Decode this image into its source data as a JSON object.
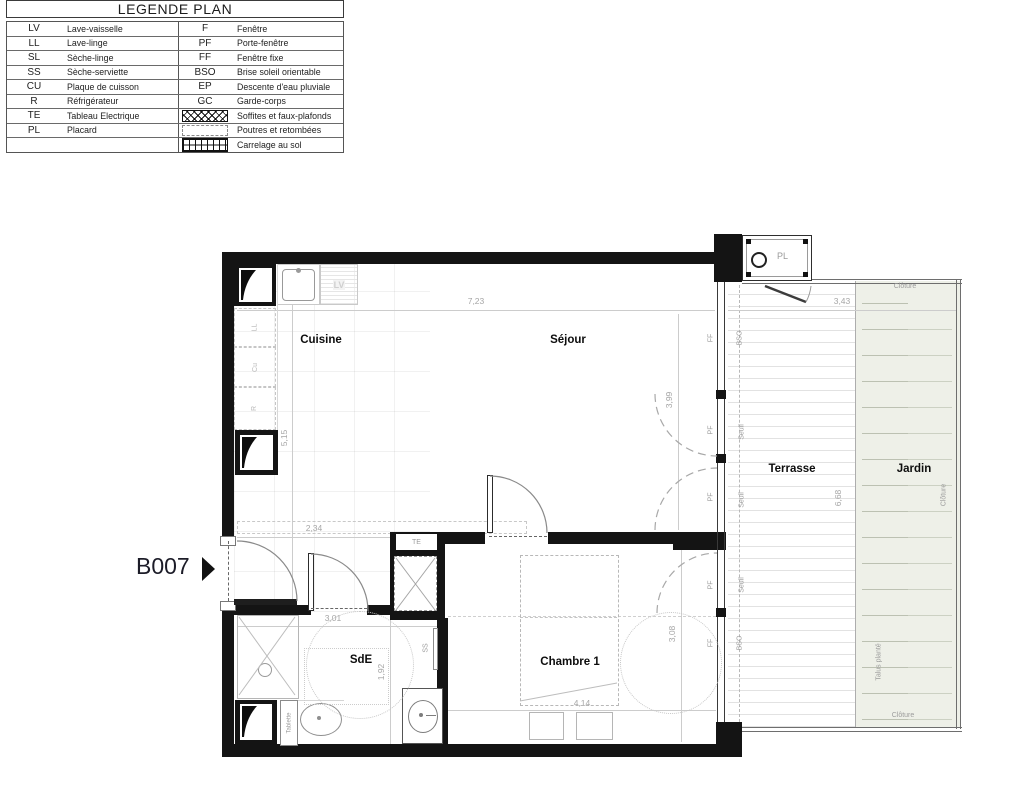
{
  "legend": {
    "title": "LEGENDE PLAN",
    "left": [
      {
        "abbr": "LV",
        "label": "Lave-vaisselle"
      },
      {
        "abbr": "LL",
        "label": "Lave-linge"
      },
      {
        "abbr": "SL",
        "label": "Sèche-linge"
      },
      {
        "abbr": "SS",
        "label": "Sèche-serviette"
      },
      {
        "abbr": "CU",
        "label": "Plaque de cuisson"
      },
      {
        "abbr": "R",
        "label": "Réfrigérateur"
      },
      {
        "abbr": "TE",
        "label": "Tableau Electrique"
      },
      {
        "abbr": "PL",
        "label": "Placard"
      },
      {
        "abbr": "",
        "label": ""
      }
    ],
    "right": [
      {
        "abbr": "F",
        "label": "Fenêtre"
      },
      {
        "abbr": "PF",
        "label": "Porte-fenêtre"
      },
      {
        "abbr": "FF",
        "label": "Fenêtre fixe"
      },
      {
        "abbr": "BSO",
        "label": "Brise soleil orientable"
      },
      {
        "abbr": "EP",
        "label": "Descente d'eau pluviale"
      },
      {
        "abbr": "GC",
        "label": "Garde-corps"
      },
      {
        "abbr": "",
        "label": "Soffites et faux-plafonds",
        "symbol": "x-hatch"
      },
      {
        "abbr": "",
        "label": "Poutres et retombées",
        "symbol": "dashed-rect"
      },
      {
        "abbr": "",
        "label": "Carrelage au sol",
        "symbol": "tile-grid"
      }
    ]
  },
  "plan": {
    "unit": "B007",
    "rooms": {
      "cuisine": "Cuisine",
      "sejour": "Séjour",
      "sde": "SdE",
      "chambre": "Chambre 1",
      "terrasse": "Terrasse",
      "jardin": "Jardin"
    },
    "dims": {
      "d723": "7,23",
      "d343": "3,43",
      "d515": "5,15",
      "d234": "2,34",
      "d399": "3,99",
      "d301": "3,01",
      "d192": "1,92",
      "d414": "4,14",
      "d308": "3,08",
      "d668": "6,68"
    },
    "labels": {
      "pf": "PF",
      "ff": "FF",
      "bso": "BSO",
      "seuil": "Seuil",
      "ss": "SS",
      "te": "TE",
      "tablette": "Tablette",
      "pl": "PL",
      "lv": "LV",
      "ll": "LL",
      "cu": "Cu",
      "r": "R",
      "cloture": "Clôture",
      "talus": "Talus planté"
    },
    "colors": {
      "wall": "#141414",
      "jardin_fill": "#eef0e8",
      "line_gray": "#9c9c9c",
      "dim_text": "#a6a6a6",
      "room_text": "#0d0d0d"
    }
  }
}
